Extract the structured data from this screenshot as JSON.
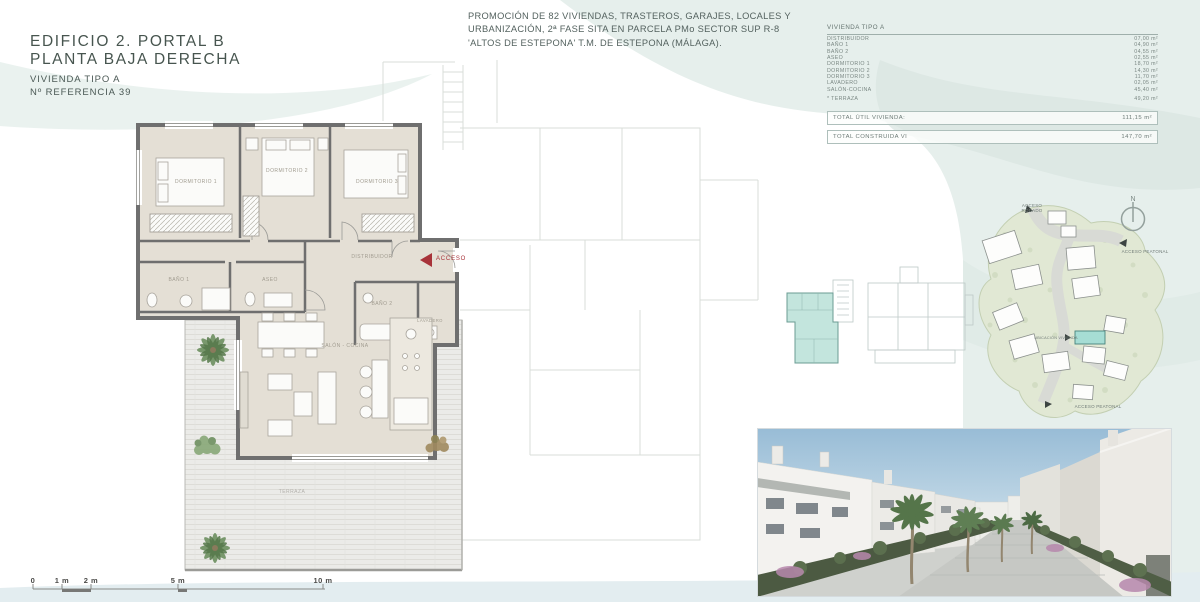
{
  "header": {
    "title_line1": "EDIFICIO 2. PORTAL B",
    "title_line2": "PLANTA BAJA DERECHA",
    "subtitle_line1": "VIVIENDA TIPO A",
    "subtitle_line2": "Nº REFERENCIA 39"
  },
  "promo": {
    "line1": "PROMOCIÓN DE 82 VIVIENDAS, TRASTEROS, GARAJES, LOCALES Y",
    "line2": "URBANIZACIÓN, 2ª FASE SITA EN PARCELA PMo SECTOR SUP R-8",
    "line3": "'ALTOS DE ESTEPONA' T.M. DE ESTEPONA (MÁLAGA)."
  },
  "area_table": {
    "title": "VIVIENDA TIPO A",
    "rows": [
      {
        "label": "DISTRIBUIDOR",
        "value": "07,00 m²"
      },
      {
        "label": "BAÑO 1",
        "value": "04,90 m²"
      },
      {
        "label": "BAÑO 2",
        "value": "04,55 m²"
      },
      {
        "label": "ASEO",
        "value": "02,55 m²"
      },
      {
        "label": "DORMITORIO 1",
        "value": "18,70 m²"
      },
      {
        "label": "DORMITORIO 2",
        "value": "14,30 m²"
      },
      {
        "label": "DORMITORIO 3",
        "value": "11,70 m²"
      },
      {
        "label": "LAVADERO",
        "value": "02,05 m²"
      },
      {
        "label": "SALÓN-COCINA",
        "value": "45,40 m²"
      },
      {
        "label": "* TERRAZA",
        "value": "49,20 m²"
      }
    ],
    "totals": [
      {
        "label": "TOTAL ÚTIL VIVIENDA:",
        "value": "111,15 m²"
      },
      {
        "label": "TOTAL CONSTRUIDA VI",
        "value": "147,70 m²"
      }
    ]
  },
  "floor_plan": {
    "labels": {
      "dormitorio1": "DORMITORIO 1",
      "dormitorio2": "DORMITORIO 2",
      "dormitorio3": "DORMITORIO 3",
      "bano1": "BAÑO 1",
      "aseo": "ASEO",
      "distribuidor": "DISTRIBUIDOR",
      "bano2": "BAÑO 2",
      "lavadero": "LAVADERO",
      "salon": "SALÓN - COCINA",
      "terraza": "TERRAZA",
      "acceso": "ACCESO"
    }
  },
  "site_plan": {
    "compass": "N",
    "labels": {
      "acceso_rodado": "ACCESO RODADO",
      "acceso_peatonal_right": "ACCESO PEATONAL",
      "acceso_peatonal_bottom": "ACCESO PEATONAL",
      "ubicacion": "UBICACIÓN VIVIENDA"
    }
  },
  "scale_bar": {
    "labels": [
      "0",
      "1 m",
      "2 m",
      "5 m",
      "10 m"
    ]
  },
  "colors": {
    "accent_red": "#a8333a",
    "highlight_teal": "#c3e5dd",
    "wall_grey": "#6f6f6f",
    "floor_beige": "#e4dfd5",
    "wave_teal": "#e6efec",
    "site_green": "#e1e8d4"
  }
}
